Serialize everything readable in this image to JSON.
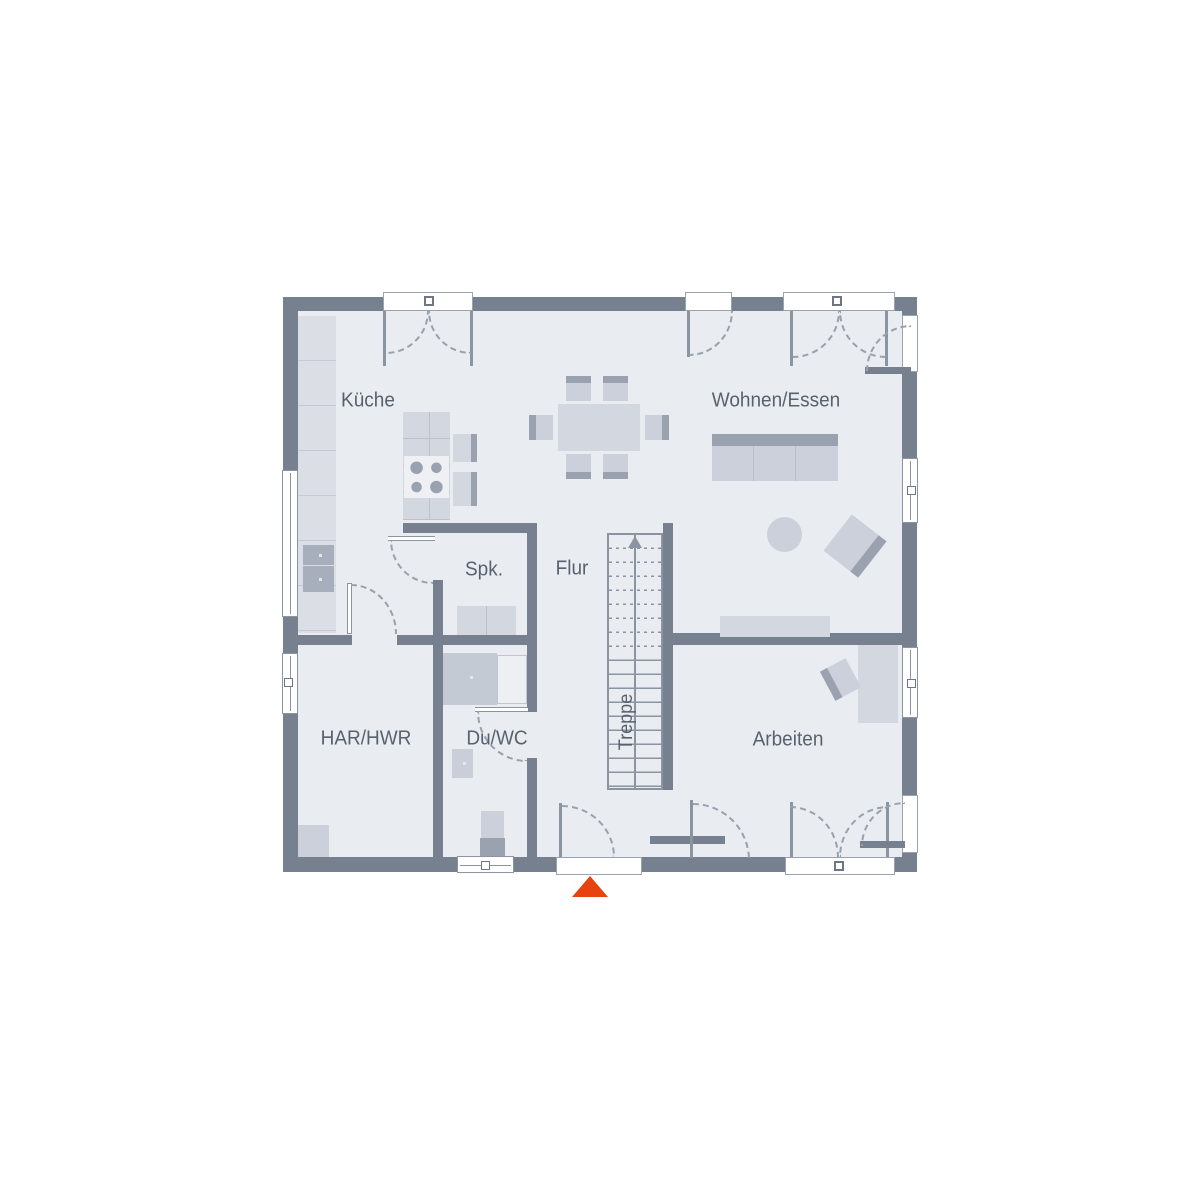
{
  "plan": {
    "title": "Erdgeschoss Grundriss",
    "rooms": {
      "kueche": "Küche",
      "wohnen_essen": "Wohnen/Essen",
      "spk": "Spk.",
      "flur": "Flur",
      "treppe": "Treppe",
      "har_hwr": "HAR/HWR",
      "du_wc": "Du/WC",
      "arbeiten": "Arbeiten"
    },
    "entrance_marker": {
      "shape": "triangle-up",
      "color": "#E8420F"
    },
    "colors": {
      "wall": "#76808E",
      "floor": "#E9ECF1",
      "furniture_light": "#D3D7DF",
      "furniture_dark": "#9AA2B0",
      "line": "#8B95A1",
      "text": "#58626E",
      "background": "#FFFFFF"
    }
  }
}
